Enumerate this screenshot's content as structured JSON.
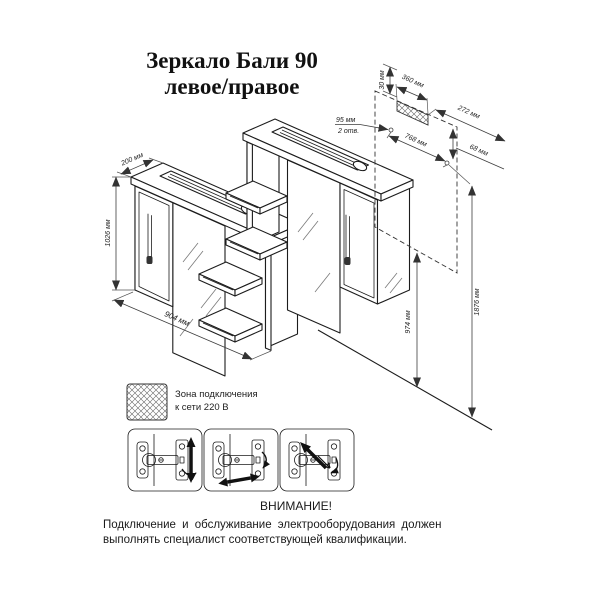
{
  "title": {
    "line1": "Зеркало Бали 90",
    "line2": "левое/правое"
  },
  "cabinet_dimensions": {
    "depth": "200 мм",
    "height": "1026 мм",
    "width": "904 мм"
  },
  "wall_mounting_dimensions": {
    "top_offset": "30 мм",
    "zone_width": "360 мм",
    "dim_272": "272 мм",
    "dim_68": "68 мм",
    "holes_offset": "95 мм",
    "holes_note": "2 отв.",
    "holes_spacing": "768 мм",
    "bottom_height": "974 мм",
    "total_height": "1876 мм"
  },
  "legend": {
    "line1": "Зона подключения",
    "line2": "к сети 220 В"
  },
  "warning": {
    "heading": "ВНИМАНИЕ!",
    "line1": "Подключение  и  обслуживание  электрооборудования  должен",
    "line2": "выполнять специалист соответствующей квалификации."
  },
  "icons": {
    "legend_swatch": "crosshatch-pattern",
    "hinge_1": "hinge-vertical-adjust-icon",
    "hinge_2": "hinge-horizontal-adjust-icon",
    "hinge_3": "hinge-depth-adjust-icon"
  },
  "colors": {
    "background": "#ffffff",
    "object_line": "#1c1c1c",
    "dimension_line": "#3d3d3d"
  }
}
